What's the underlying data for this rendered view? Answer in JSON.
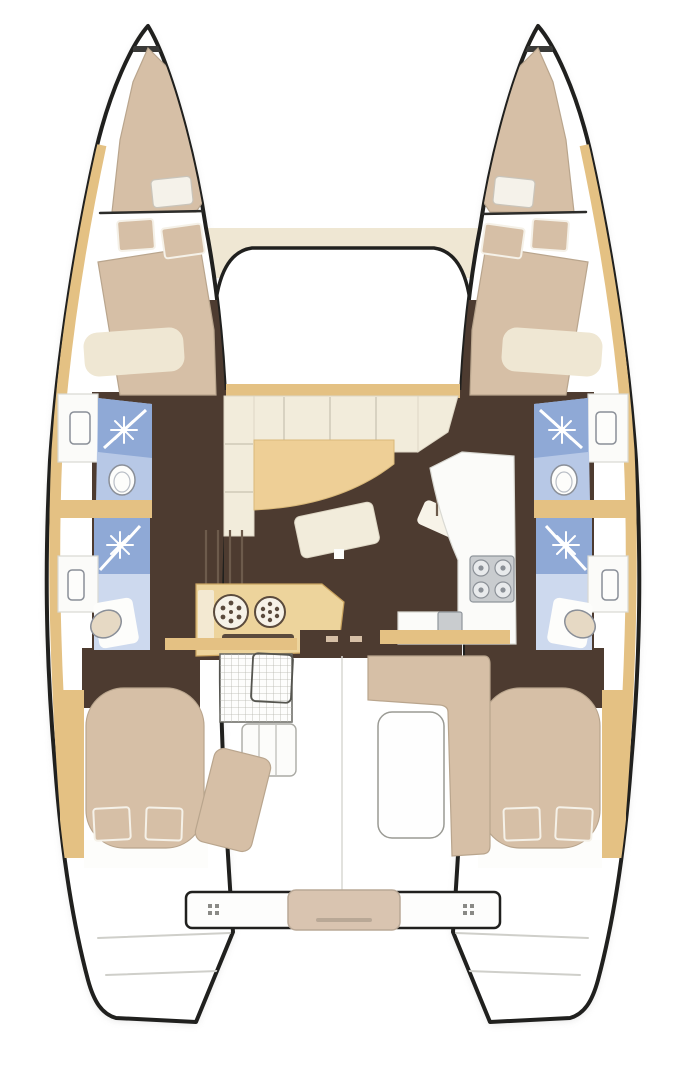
{
  "diagram": {
    "title": "Sailing catamaran interior layout — top-down floor plan",
    "type": "yacht-floor-plan",
    "view": "overhead",
    "hull_count": 2
  },
  "colors": {
    "outline": "#20201e",
    "deck": "#ffffff",
    "shadow": "#bcbcbc",
    "wood": "#e4c183",
    "wood_light": "#edd49c",
    "cushion": "#d6bfa6",
    "sofa": "#f2ecdb",
    "cream": "#efe7d3",
    "table": "#eecf96",
    "floor": "#4d3b30",
    "floor_line": "#6d5b4c",
    "bath": "#b7c8e6",
    "shower": "#8fa9d6",
    "bath_light": "#cdd9ee",
    "counter": "#fbfbf9",
    "steel": "#c9cccf",
    "steel_dark": "#8f959b",
    "platform": "#d9c4b0",
    "trim": "#b9a58d",
    "grid": "#b5b5ae"
  },
  "areas": {
    "port_hull": {
      "spaces": [
        {
          "name": "forepeak-berth",
          "fixtures": [
            "mattress",
            "pillow"
          ]
        },
        {
          "name": "forward-cabin",
          "fixtures": [
            "double-berth",
            "pillow",
            "pillow"
          ]
        },
        {
          "name": "forward-head",
          "fixtures": [
            "shower",
            "toilet",
            "sink-counter"
          ]
        },
        {
          "name": "aft-head",
          "fixtures": [
            "shower",
            "toilet",
            "sink-counter"
          ]
        },
        {
          "name": "aft-cabin",
          "fixtures": [
            "double-berth",
            "pillow",
            "pillow"
          ]
        }
      ]
    },
    "starboard_hull": {
      "spaces": [
        {
          "name": "forepeak-berth",
          "fixtures": [
            "mattress",
            "pillow"
          ]
        },
        {
          "name": "forward-cabin",
          "fixtures": [
            "double-berth",
            "pillow",
            "pillow"
          ]
        },
        {
          "name": "forward-head",
          "fixtures": [
            "shower",
            "toilet",
            "sink-counter"
          ]
        },
        {
          "name": "aft-head",
          "fixtures": [
            "shower",
            "toilet",
            "sink-counter"
          ]
        },
        {
          "name": "aft-cabin",
          "fixtures": [
            "double-berth",
            "pillow",
            "pillow"
          ]
        }
      ]
    },
    "main_deck": {
      "spaces": [
        {
          "name": "salon",
          "fixtures": [
            "u-sofa",
            "dining-table",
            "ottoman",
            "chaise"
          ]
        },
        {
          "name": "galley",
          "fixtures": [
            "l-counter",
            "four-burner-stove",
            "twin-round-sinks",
            "oven-slot"
          ]
        },
        {
          "name": "companionway-stairs",
          "count": 2
        },
        {
          "name": "cockpit",
          "fixtures": [
            "grid-table",
            "chair",
            "bench-seats",
            "lounge-seat",
            "cockpit-table",
            "corner-lounge"
          ]
        },
        {
          "name": "transom",
          "fixtures": [
            "aft-beam",
            "dinghy-platform",
            "cleats",
            "swim-steps"
          ]
        }
      ]
    },
    "foredeck": {
      "spaces": [
        {
          "name": "forward-crossbeam"
        },
        {
          "name": "coachroof-front"
        }
      ]
    }
  }
}
